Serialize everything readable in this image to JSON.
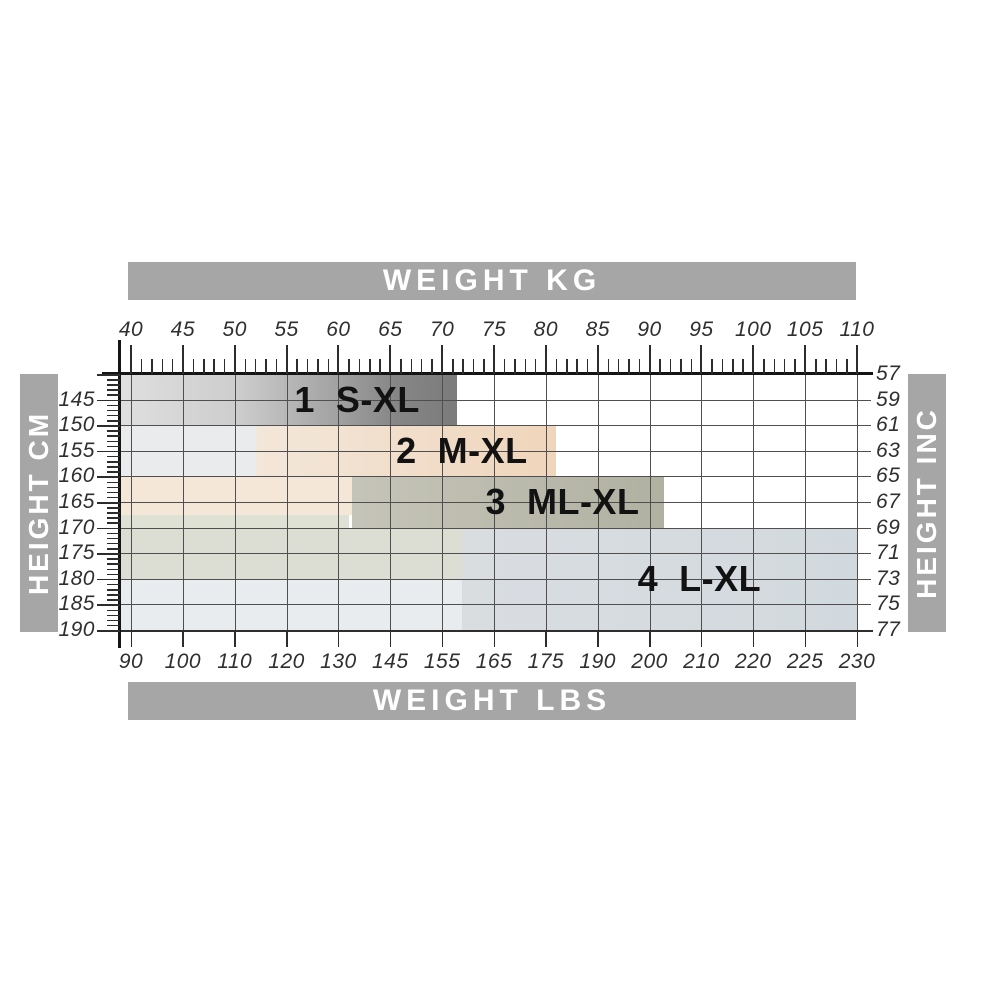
{
  "bars": {
    "top": "WEIGHT KG",
    "bottom": "WEIGHT LBS",
    "left": "HEIGHT CM",
    "right": "HEIGHT INC"
  },
  "colors": {
    "bar_bg": "#a6a6a6",
    "bar_text": "#ffffff",
    "grid": "#4f4f4f",
    "axis": "#141414",
    "tick_text": "#2f2f2f",
    "region_text": "#121212"
  },
  "chart_data": {
    "type": "area",
    "x_axis_top": {
      "label": "WEIGHT KG",
      "unit": "kg",
      "ticks": [
        40,
        45,
        50,
        55,
        60,
        65,
        70,
        75,
        80,
        85,
        90,
        95,
        100,
        105,
        110
      ],
      "minor_step": 1,
      "range": [
        40,
        110
      ]
    },
    "x_axis_bottom": {
      "label": "WEIGHT LBS",
      "unit": "lbs",
      "tick_labels": [
        "90",
        "100",
        "110",
        "120",
        "130",
        "145",
        "155",
        "165",
        "175",
        "190",
        "200",
        "210",
        "220",
        "225",
        "230"
      ]
    },
    "y_axis_left": {
      "label": "HEIGHT CM",
      "unit": "cm",
      "ticks": [
        145,
        150,
        155,
        160,
        165,
        170,
        175,
        180,
        185,
        190
      ]
    },
    "y_axis_right": {
      "label": "HEIGHT INC",
      "unit": "inch",
      "ticks": [
        57,
        59,
        61,
        63,
        65,
        67,
        69,
        71,
        73,
        75,
        77
      ]
    },
    "regions": [
      {
        "number": "1",
        "size_range": "S-XL",
        "label": "1  S-XL",
        "kg_min": 40,
        "kg_max": 71.4,
        "row_start": 0,
        "row_end": 2,
        "gradient": [
          "#dfdfdf 0%",
          "#cdcdcd 35%",
          "#a5a5a5 62%",
          "#868686 82%",
          "#7b7b7b 100%"
        ],
        "label_kg": 61.8
      },
      {
        "number": "2",
        "size_range": "M-XL",
        "label": "2  M-XL",
        "kg_min": 52.1,
        "kg_max": 81,
        "row_start": 2,
        "row_end": 4,
        "gradient": [
          "#f3e7da 0%",
          "#efd5bb 100%"
        ],
        "label_kg": 71.9
      },
      {
        "number": "3",
        "size_range": "ML-XL",
        "label": "3  ML-XL",
        "kg_min": 61.3,
        "kg_max": 91.4,
        "row_start": 4,
        "row_end": 6,
        "gradient": [
          "#c5c4b8 0%",
          "#b1b1a2 100%"
        ],
        "label_kg": 81.6
      },
      {
        "number": "4",
        "size_range": "L-XL",
        "label": "4  L-XL",
        "kg_min": 71.9,
        "kg_max": 110,
        "row_start": 6,
        "row_end": 10,
        "gradient": [
          "#d9dde0 0%",
          "#d2d9de 100%"
        ],
        "label_kg": 94.8
      }
    ],
    "underlays": [
      {
        "kg_min": 40,
        "kg_max": 52.1,
        "row_start": 2,
        "row_end": 4,
        "color": "#e9ebec"
      },
      {
        "kg_min": 40,
        "kg_max": 61.7,
        "row_start": 4,
        "row_end": 5.5,
        "color": "#f4e7d8"
      },
      {
        "kg_min": 40,
        "kg_max": 61.0,
        "row_start": 5.5,
        "row_end": 6,
        "color": "#e0e1d5"
      },
      {
        "kg_min": 40,
        "kg_max": 71.9,
        "row_start": 6,
        "row_end": 8,
        "color": "#dcded3"
      },
      {
        "kg_min": 40,
        "kg_max": 71.9,
        "row_start": 8,
        "row_end": 10,
        "color": "#e8ecef"
      }
    ]
  }
}
